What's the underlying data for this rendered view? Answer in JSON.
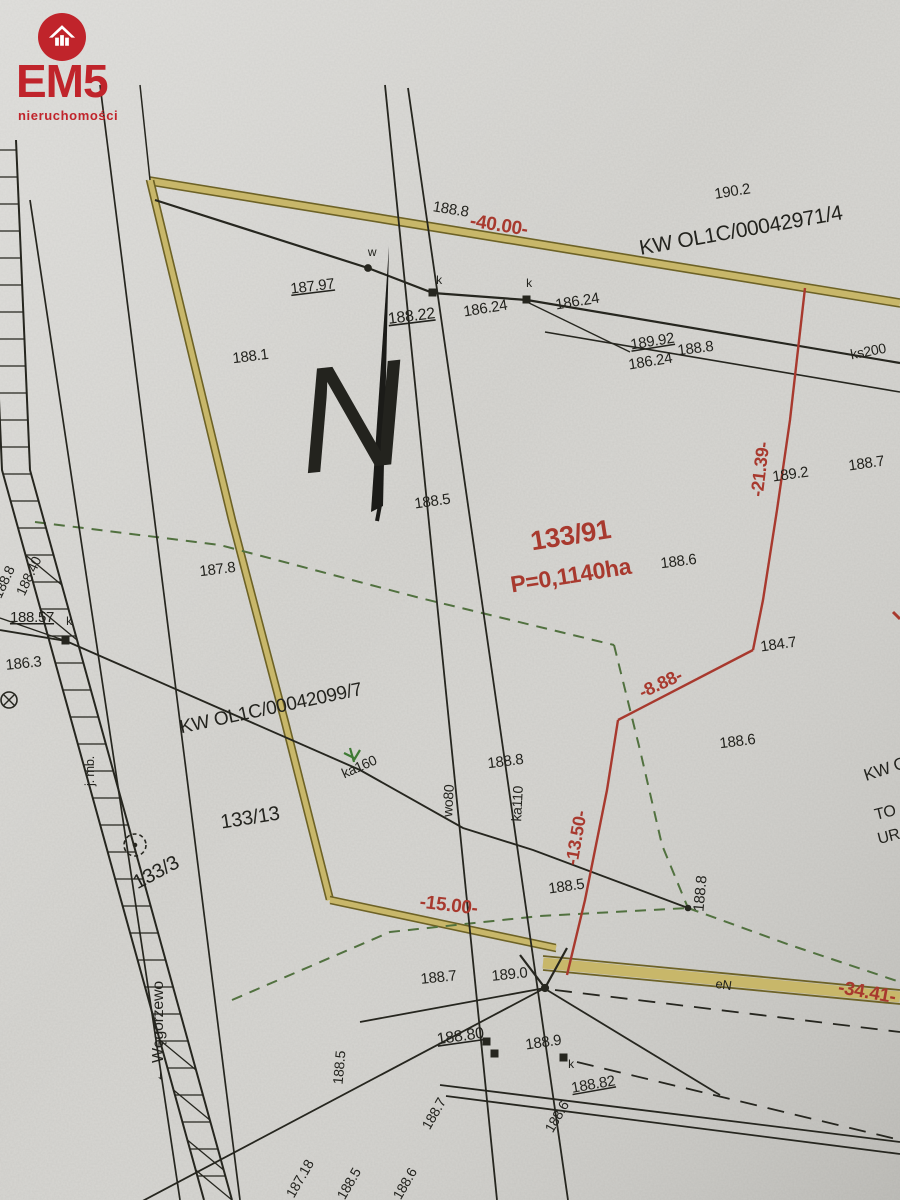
{
  "logo": {
    "brand": "EM5",
    "subtitle": "nieruchomości",
    "accent_color": "#c0242b",
    "icon": "house-icon"
  },
  "map": {
    "north_label": "N",
    "parcel_number": "133/91",
    "parcel_area": "P=0,1140ha",
    "register_numbers": {
      "top": "KW OL1C/00042971/4",
      "left": "KW OL1C/00042099/7"
    },
    "adjacent_plots": [
      "133/13",
      "133/3"
    ],
    "road_direction": "← Węgorzewo",
    "unit_note": "j. mb.",
    "red_measurements": [
      "-40.00-",
      "-21.39-",
      "-8.88-",
      "-13.50-",
      "-15.00-",
      "-34.41-"
    ],
    "utility_labels": [
      "ks200",
      "ka160",
      "wo80",
      "ka110",
      "eN"
    ],
    "colors": {
      "red": "#a8392e",
      "yellow_band": "#c8b76a",
      "yellow_edge": "#6d6226",
      "green_dash": "#51713f",
      "ink": "#23231e",
      "paper": "#d7d6d2"
    },
    "labels": [
      {
        "t": "190.2",
        "x": 733,
        "y": 196,
        "r": -9,
        "s": 15
      },
      {
        "t": "KW OL1C/00042971/4",
        "x": 742,
        "y": 237,
        "r": -10,
        "s": 21
      },
      {
        "t": "188.8",
        "x": 450,
        "y": 214,
        "r": 9,
        "s": 15
      },
      {
        "t": "-40.00-",
        "x": 498,
        "y": 231,
        "r": 9,
        "s": 19,
        "c": "red",
        "w": 600
      },
      {
        "t": "187.97",
        "x": 313,
        "y": 291,
        "r": -7,
        "s": 15,
        "u": 1
      },
      {
        "t": "w",
        "x": 372,
        "y": 256,
        "r": 0,
        "s": 12
      },
      {
        "t": "188.22",
        "x": 412,
        "y": 321,
        "r": -7,
        "s": 16,
        "u": 1
      },
      {
        "t": "k",
        "x": 439,
        "y": 284,
        "r": 0,
        "s": 12
      },
      {
        "t": "186.24",
        "x": 486,
        "y": 313,
        "r": -9,
        "s": 15
      },
      {
        "t": "k",
        "x": 529,
        "y": 287,
        "r": 0,
        "s": 12
      },
      {
        "t": "186.24",
        "x": 578,
        "y": 306,
        "r": -9,
        "s": 15
      },
      {
        "t": "189.92",
        "x": 653,
        "y": 346,
        "r": -9,
        "s": 15,
        "u": 1
      },
      {
        "t": "186.24",
        "x": 651,
        "y": 366,
        "r": -9,
        "s": 15
      },
      {
        "t": "188.1",
        "x": 251,
        "y": 361,
        "r": -7,
        "s": 15
      },
      {
        "t": "188.8",
        "x": 696,
        "y": 353,
        "r": -7,
        "s": 15
      },
      {
        "t": "ks200",
        "x": 869,
        "y": 356,
        "r": -11,
        "s": 14
      },
      {
        "t": "189.2",
        "x": 791,
        "y": 479,
        "r": -8,
        "s": 15
      },
      {
        "t": "188.7",
        "x": 867,
        "y": 468,
        "r": -8,
        "s": 15
      },
      {
        "t": "-21.39-",
        "x": 766,
        "y": 470,
        "r": -83,
        "s": 18,
        "c": "red",
        "w": 600
      },
      {
        "t": "188.5",
        "x": 433,
        "y": 506,
        "r": -8,
        "s": 15
      },
      {
        "t": "133/91",
        "x": 572,
        "y": 544,
        "r": -9,
        "s": 27,
        "c": "red",
        "w": 600
      },
      {
        "t": "P=0,1140ha",
        "x": 572,
        "y": 583,
        "r": -9,
        "s": 23,
        "c": "red",
        "w": 600
      },
      {
        "t": "188.6",
        "x": 679,
        "y": 566,
        "r": -7,
        "s": 15
      },
      {
        "t": "187.8",
        "x": 218,
        "y": 574,
        "r": -7,
        "s": 15
      },
      {
        "t": "188.8",
        "x": 8,
        "y": 584,
        "r": -65,
        "s": 14
      },
      {
        "t": "188.40",
        "x": 33,
        "y": 578,
        "r": -65,
        "s": 14
      },
      {
        "t": "188.57",
        "x": 32,
        "y": 622,
        "r": 0,
        "s": 15,
        "u": 1
      },
      {
        "t": "k",
        "x": 69,
        "y": 625,
        "r": 0,
        "s": 12
      },
      {
        "t": "186.3",
        "x": 24,
        "y": 668,
        "r": -6,
        "s": 15
      },
      {
        "t": "KW OL1C/00042099/7",
        "x": 272,
        "y": 714,
        "r": -12,
        "s": 19
      },
      {
        "t": "184.7",
        "x": 779,
        "y": 649,
        "r": -8,
        "s": 15
      },
      {
        "t": "-8.88-",
        "x": 663,
        "y": 689,
        "r": -25,
        "s": 18,
        "c": "red",
        "w": 600
      },
      {
        "t": "188.6",
        "x": 738,
        "y": 746,
        "r": -7,
        "s": 15
      },
      {
        "t": "188.8",
        "x": 506,
        "y": 766,
        "r": -7,
        "s": 15
      },
      {
        "t": "ka160",
        "x": 361,
        "y": 771,
        "r": -24,
        "s": 14
      },
      {
        "t": "wo80",
        "x": 453,
        "y": 801,
        "r": -87,
        "s": 14
      },
      {
        "t": "ka110",
        "x": 522,
        "y": 804,
        "r": -87,
        "s": 14
      },
      {
        "t": "133/13",
        "x": 251,
        "y": 824,
        "r": -9,
        "s": 20
      },
      {
        "t": "133/3",
        "x": 159,
        "y": 878,
        "r": -28,
        "s": 20
      },
      {
        "t": "j. mb.",
        "x": 94,
        "y": 771,
        "r": -90,
        "s": 13
      },
      {
        "t": "← Węgorzewo",
        "x": 163,
        "y": 1032,
        "r": -90,
        "s": 16
      },
      {
        "t": "-13.50-",
        "x": 582,
        "y": 839,
        "r": -80,
        "s": 18,
        "c": "red",
        "w": 600
      },
      {
        "t": "188.5",
        "x": 567,
        "y": 891,
        "r": -8,
        "s": 15
      },
      {
        "t": "188.8",
        "x": 705,
        "y": 894,
        "r": -85,
        "s": 15
      },
      {
        "t": "-15.00-",
        "x": 448,
        "y": 911,
        "r": 7,
        "s": 19,
        "c": "red",
        "w": 600
      },
      {
        "t": "188.7",
        "x": 439,
        "y": 982,
        "r": -6,
        "s": 15
      },
      {
        "t": "189.0",
        "x": 510,
        "y": 979,
        "r": -6,
        "s": 15
      },
      {
        "t": "eN",
        "x": 723,
        "y": 989,
        "r": 8,
        "s": 13
      },
      {
        "t": "-34.41-",
        "x": 866,
        "y": 998,
        "r": 10,
        "s": 19,
        "c": "red",
        "w": 600
      },
      {
        "t": "188.80",
        "x": 461,
        "y": 1041,
        "r": -8,
        "s": 16,
        "u": 1
      },
      {
        "t": "188.9",
        "x": 544,
        "y": 1047,
        "r": -8,
        "s": 15
      },
      {
        "t": "k",
        "x": 571,
        "y": 1068,
        "r": 0,
        "s": 12
      },
      {
        "t": "188.82",
        "x": 594,
        "y": 1089,
        "r": -10,
        "s": 15,
        "u": 1
      },
      {
        "t": "188.5",
        "x": 344,
        "y": 1068,
        "r": -85,
        "s": 14
      },
      {
        "t": "188.7",
        "x": 438,
        "y": 1116,
        "r": -60,
        "s": 14
      },
      {
        "t": "187.18",
        "x": 304,
        "y": 1181,
        "r": -60,
        "s": 14
      },
      {
        "t": "188.5",
        "x": 353,
        "y": 1186,
        "r": -60,
        "s": 14
      },
      {
        "t": "188.6",
        "x": 409,
        "y": 1186,
        "r": -60,
        "s": 14
      },
      {
        "t": "188.6",
        "x": 561,
        "y": 1119,
        "r": -60,
        "s": 14
      },
      {
        "t": "KW O",
        "x": 866,
        "y": 781,
        "r": -18,
        "s": 17,
        "a": "start"
      },
      {
        "t": "TO",
        "x": 876,
        "y": 820,
        "r": -14,
        "s": 16,
        "a": "start"
      },
      {
        "t": "UR",
        "x": 879,
        "y": 844,
        "r": -14,
        "s": 16,
        "a": "start"
      },
      {
        "t": "N",
        "x": 357,
        "y": 468,
        "r": -6,
        "s": 150,
        "f": "serif",
        "i": 1
      }
    ]
  }
}
